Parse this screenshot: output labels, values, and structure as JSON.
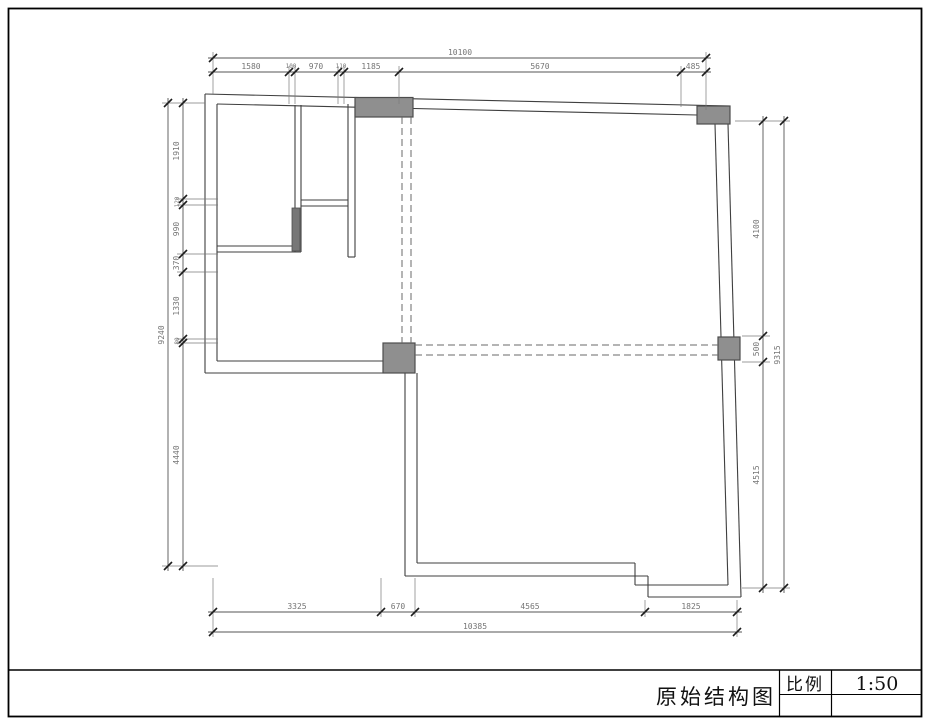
{
  "colors": {
    "column_fill": "#8f8f8f",
    "wall_line": "#3f3f3f",
    "dim_line": "#555555",
    "dim_text": "#757575",
    "border": "#000000"
  },
  "title_block": {
    "drawing_title": "原始结构图",
    "scale_label": "比例",
    "scale_value": "1:50"
  },
  "dimensions": {
    "top": {
      "overall": "10100",
      "segments": [
        "1580",
        "100",
        "970",
        "110",
        "1185",
        "5670",
        "485"
      ]
    },
    "bottom": {
      "overall": "10385",
      "segments": [
        "3325",
        "670",
        "4565",
        "1825"
      ]
    },
    "left": {
      "overall": "9240",
      "segments": [
        "1910",
        "120",
        "990",
        "370",
        "1330",
        "80",
        "4440"
      ]
    },
    "right": {
      "overall": "9315",
      "segments": [
        "4100",
        "500",
        "4515"
      ]
    }
  }
}
